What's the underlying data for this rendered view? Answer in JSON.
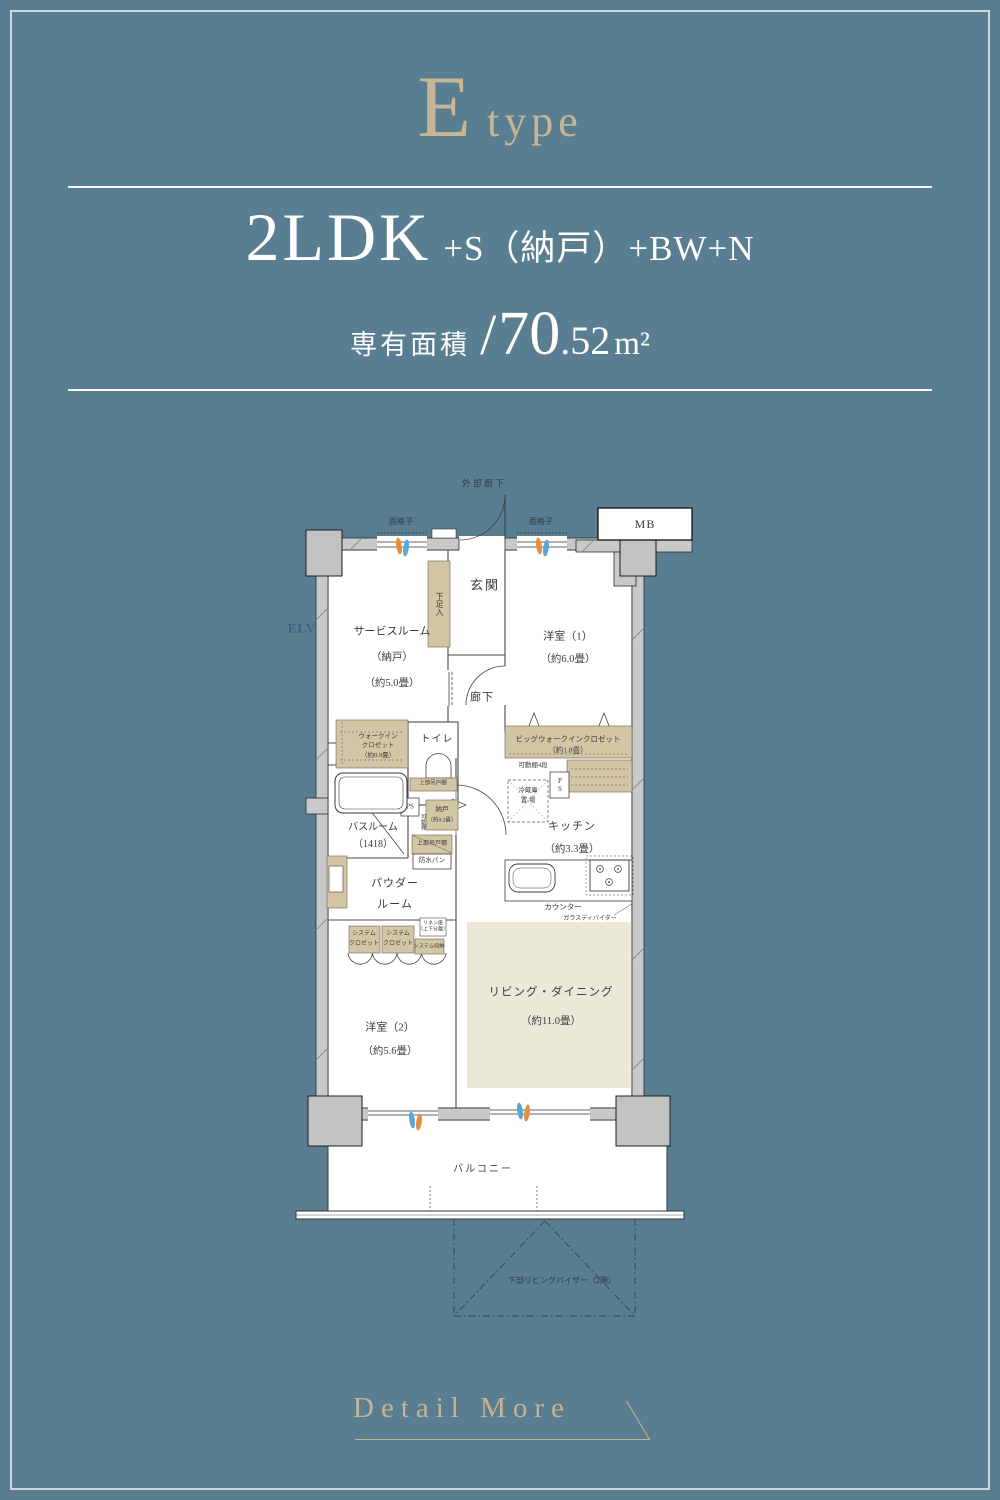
{
  "colors": {
    "background": "#597d91",
    "accent_tan": "#c7b594",
    "closet_tan": "#d3c6a4",
    "ld_floor": "#ebe8d8",
    "flame_orange": "#e2903e",
    "flame_blue": "#57a7d7"
  },
  "header": {
    "type_letter": "E",
    "type_word": "type",
    "plan_name": "2LDK",
    "plan_suffix": "+S（納戸）+BW+N",
    "area_label": "専有面積",
    "area_slash": "/",
    "area_int": "70",
    "area_dec": ".52",
    "area_unit": "m²"
  },
  "floorplan": {
    "outside": {
      "corridor": "外部廊下",
      "grille_left": "面格子",
      "grille_right": "面格子",
      "meter_box": "MB",
      "elevator": "ELV",
      "balcony": "バルコニー",
      "visor_note": "下部リビングバイザー（2階）"
    },
    "rooms": {
      "genkan": "玄関",
      "shoe_box": "下足入",
      "service_l1": "サービスルーム",
      "service_l2": "（納戸）",
      "service_l3": "（約5.0畳）",
      "western1_l1": "洋室（1）",
      "western1_l2": "（約6.0畳）",
      "hallway": "廊下",
      "toilet": "トイレ",
      "wic_l1": "ウォークイン",
      "wic_l2": "クロゼット",
      "wic_l3": "（約0.9畳）",
      "big_wic_l1": "ビッグウォークインクロゼット",
      "big_wic_l2": "（約1.8畳）",
      "movable_shelf_4": "可動棚4段",
      "ps_1": "PS",
      "ps_2": "PS",
      "fridge_l1": "冷蔵庫",
      "fridge_l2": "置 場",
      "kitchen_l1": "キッチン",
      "kitchen_l2": "（約3.3畳）",
      "counter": "カウンター",
      "glass_divider": "ガラスディバイダー",
      "storeroom_l1": "納戸",
      "storeroom_l2": "（約0.3畳）",
      "movable_shelf": "可動棚",
      "upper_cabinet_1": "上部吊戸棚",
      "upper_cabinet_2": "上部吊戸棚",
      "waterproof_pan": "防水パン",
      "bathroom_l1": "バスルーム",
      "bathroom_l2": "（1418）",
      "powder_l1": "パウダー",
      "powder_l2": "ルーム",
      "sys_closet_a_l1": "システム",
      "sys_closet_a_l2": "クロゼット",
      "sys_closet_b_l1": "システム",
      "sys_closet_b_l2": "クロゼット",
      "sys_storage": "システム収納",
      "linen_l1": "リネン庫",
      "linen_l2": "（上下分離）",
      "western2_l1": "洋室（2）",
      "western2_l2": "（約5.6畳）",
      "living_l1": "リビング・ダイニング",
      "living_l2": "（約11.0畳）"
    }
  },
  "footer": {
    "detail_more": "Detail More"
  }
}
